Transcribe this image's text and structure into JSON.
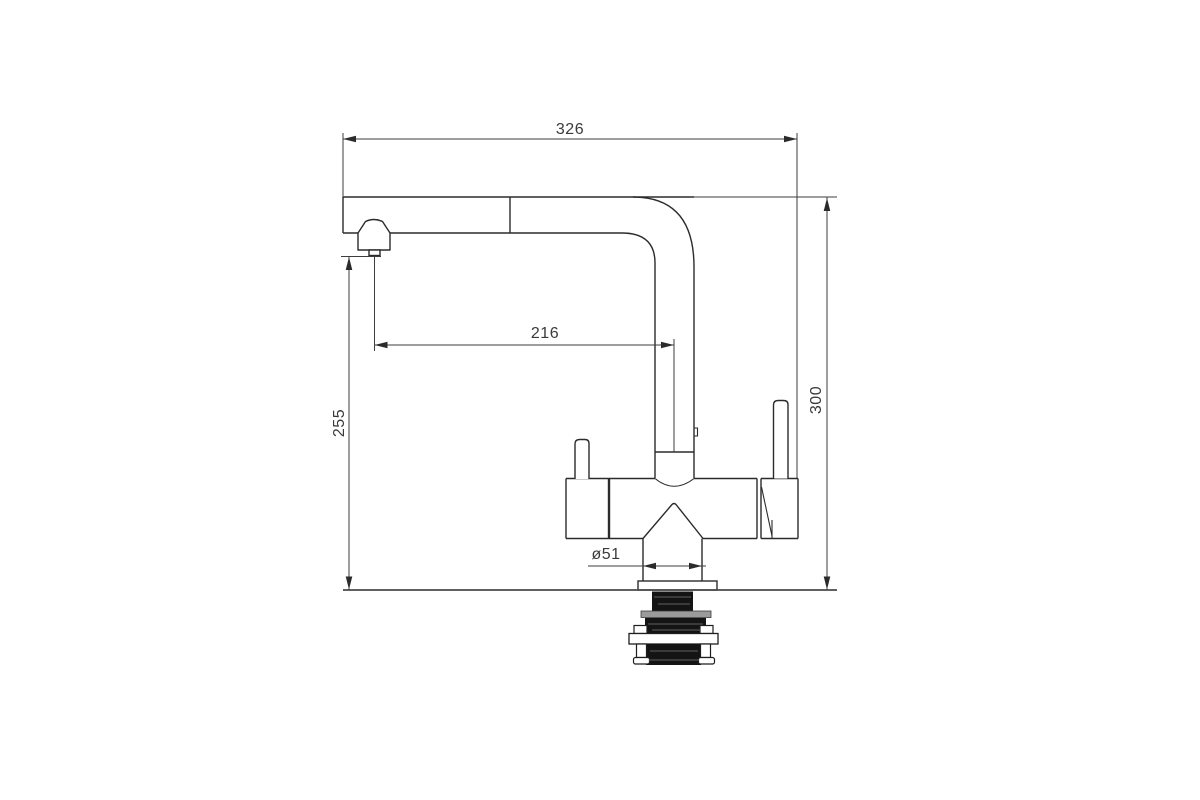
{
  "drawing": {
    "subject": "pull-out kitchen mixer tap - dimensioned side elevation",
    "dimensions": {
      "overall_width": {
        "value": "326",
        "orientation": "horizontal",
        "measures": "overall width from spout tip to handle side"
      },
      "spout_reach": {
        "value": "216",
        "orientation": "horizontal",
        "measures": "nozzle centre to riser pipe centre"
      },
      "nozzle_height": {
        "value": "255",
        "orientation": "vertical",
        "measures": "mounting surface to nozzle outlet"
      },
      "overall_height": {
        "value": "300",
        "orientation": "vertical",
        "measures": "mounting surface to top of spout"
      },
      "base_diameter": {
        "value": "ø51",
        "orientation": "horizontal",
        "measures": "base neck diameter"
      }
    },
    "colors": {
      "background": "#ffffff",
      "object_line": "#2b2b2b",
      "dimension_line": "#3d3d3d",
      "label_text": "#3a3a3a",
      "shank_fill": "#141414",
      "nut_gray": "#9b9b9b"
    }
  }
}
